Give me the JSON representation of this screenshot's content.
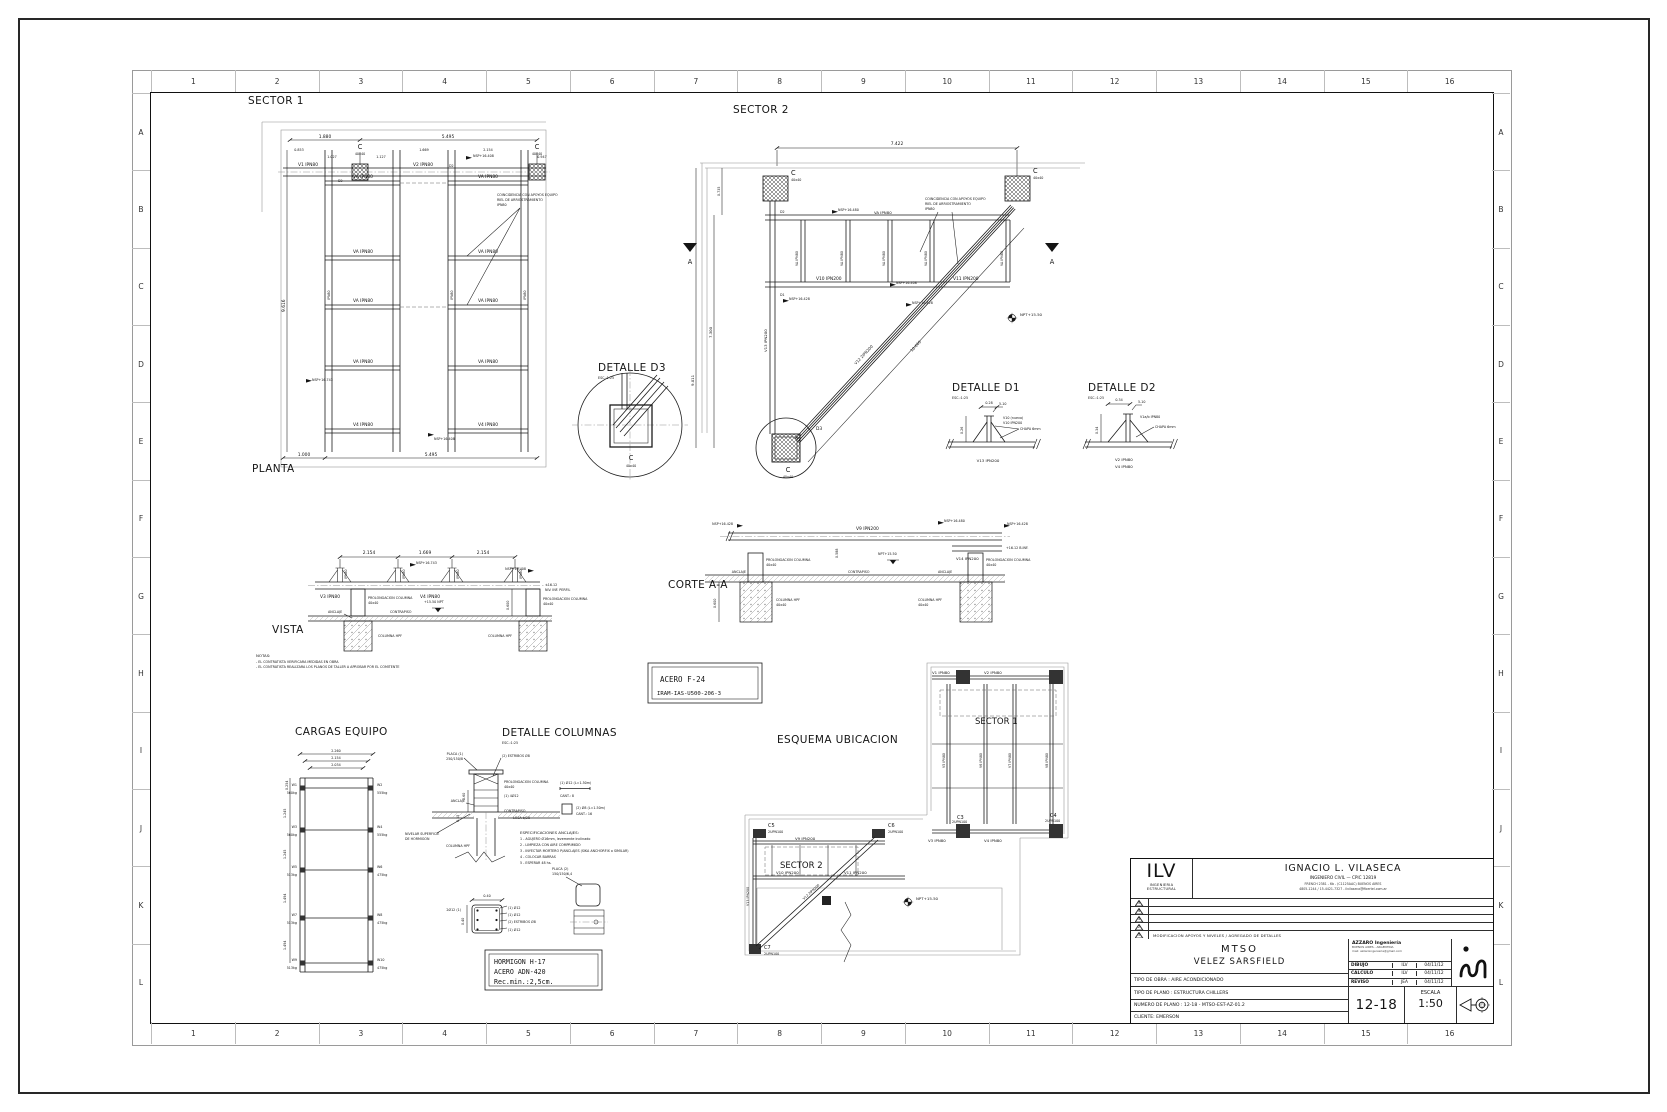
{
  "sheet": {
    "cols": [
      "1",
      "2",
      "3",
      "4",
      "5",
      "6",
      "7",
      "8",
      "9",
      "10",
      "11",
      "12",
      "13",
      "14",
      "15",
      "16"
    ],
    "rows": [
      "A",
      "B",
      "C",
      "D",
      "E",
      "F",
      "G",
      "H",
      "I",
      "J",
      "K",
      "L"
    ]
  },
  "lbl": {
    "va": "VA IPN80",
    "ipn80": "IPN80",
    "c": "C",
    "c40": "40x40",
    "a": "A",
    "nsp408": "NSP+16.408",
    "nsp428": "NSP+16.428",
    "nsp480": "NSP+16.480",
    "nsp743": "NSP+16.743",
    "npt1550": "NPT+15.50",
    "prolong1": "PROLONGACION COLUMNA",
    "prolong2": "40x40",
    "anclaje": "ANCLAJE",
    "contrapiso": "CONTRAPISO",
    "columna_hpf": "COLUMNA HPF",
    "chapa": "CHAPA 6mm",
    "weld": "5-10",
    "esc": "ESC.:1:25",
    "tag_d1": "D1",
    "tag_d2": "D2",
    "tag_d3": "D3"
  },
  "sector1": {
    "title": "SECTOR 1",
    "planta": "PLANTA",
    "dim_top1": "1.880",
    "dim_top2": "5.495",
    "sub": [
      "0.853",
      "1.027",
      "1.127",
      "1.669",
      "2.154",
      "0.947"
    ],
    "dim_left": "9.616",
    "dim_bot1": "1.000",
    "dim_bot2": "5.495",
    "v1": "V1 IPN80",
    "v2": "V2 IPN80",
    "v4": "V4 IPN80",
    "note": [
      "COINCIDENCIA CON APOYOS EQUIPO",
      "RIEL DE ARRIOSTRAMIENTO",
      "IPN80"
    ]
  },
  "sector2": {
    "title": "SECTOR 2",
    "dim_top": "7.422",
    "dim_735": "0.735",
    "dim_7300": "7.300",
    "dim_9011": "9.011",
    "dim_diag": "10.660",
    "v10": "V10 IPN200",
    "v11": "V11 IPN200",
    "v12": "V12 2IPN200",
    "v13": "V13 IPN200"
  },
  "detalles": {
    "d3_title": "DETALLE D3",
    "d1_title": "DETALLE D1",
    "d2_title": "DETALLE D2",
    "d1_dim_h": "0.28",
    "d1_dim_v": "0.26",
    "d1_new": "V10 (nuevo)",
    "d1_perfil": "V10 IPN200",
    "d1_below": "V13 IPN200",
    "d2_dim_h": "0.34",
    "d2_dim_v": "0.34",
    "d2_perfil": "V1a/b IPN80",
    "d2_below1": "V2 IPN80",
    "d2_below2": "V4 IPN80"
  },
  "vista": {
    "title": "VISTA",
    "dims": [
      "2.154",
      "1.669",
      "2.154"
    ],
    "v3": "V3 IPN80",
    "v4": "V4 IPN80",
    "dim_v": "0.600",
    "npt": "+15.50 NPT",
    "inf1": "+16.12",
    "inf2": "NIV. INF. PERFIL"
  },
  "corte": {
    "title": "CORTE A-A",
    "v9": "V9 IPN200",
    "v14": "V14 IPN200",
    "dim1": "0.600",
    "dim2": "0.588",
    "inf": "+16.12 B.INF."
  },
  "notas": {
    "title": "NOTAS:",
    "l1": "- EL CONTRATISTA VERIFICARA MEDIDAS EN OBRA",
    "l2": "- EL CONTRATISTA REALIZARA LOS PLANOS DE TALLER A APROBAR POR EL COMITENTE"
  },
  "acero": {
    "l1": "ACERO  F-24",
    "l2": "IRAM-IAS-U500-206-3"
  },
  "hormigon": {
    "l1": "HORMIGON H-17",
    "l2": "ACERO ADN-420",
    "l3": "Rec.min.:2,5cm."
  },
  "cargas": {
    "title": "CARGAS EQUIPO",
    "dims_top": [
      "2.260",
      "2.154",
      "2.034"
    ],
    "dims_left": [
      "0.254",
      "1.245",
      "1.245",
      "1.494",
      "1.494"
    ],
    "rows": [
      {
        "wl": "W1",
        "kl": "560kg",
        "wr": "W2",
        "kr": "555kg"
      },
      {
        "wl": "W3",
        "kl": "560kg",
        "wr": "W4",
        "kr": "555kg"
      },
      {
        "wl": "W5",
        "kl": "513kg",
        "wr": "W6",
        "kr": "475kg"
      },
      {
        "wl": "W7",
        "kl": "513kg",
        "wr": "W8",
        "kr": "475kg"
      },
      {
        "wl": "W9",
        "kl": "513kg",
        "wr": "W10",
        "kr": "475kg"
      }
    ]
  },
  "columnas": {
    "title": "DETALLE COLUMNAS",
    "placa1a": "PLACA (1)",
    "placa1b": "250/150/8",
    "estribos": "(2) ESTRIBOS Ø8",
    "barras": "(1) 4Ø12",
    "losa": "LOSA e/20",
    "nivelar1": "NIVELAR SUPERFICIE",
    "nivelar2": "DE HORMIGON",
    "col_dim1": "0.60",
    "col_dim2": "0.15",
    "specs": [
      "ESPECIFICACIONES ANCLAJES:",
      "1 - AGUJERO Ø16mm, levemente inclinado",
      "2 - LIMPIEZA CON AIRE COMPRIMIDO",
      "3 - INYECTAR MORTERO P/ANCLAJES (SIKA ANCHORFIX o SIMILAR)",
      "4 - COLOCAR BARRAS",
      "5 - ESPERAR 48 hs."
    ],
    "sec_dim": "0.40",
    "sec_l": "2Ø12 (1)",
    "sec_r1": "(1) Ø12",
    "sec_r2": "(1) Ø12",
    "sec_r3": "(2) ESTRIBOS Ø8",
    "sec_r4": "(1) Ø12",
    "sch1a": "(1) Ø12 (L=1.50m)",
    "sch1b": "CANT.: 8",
    "sch2a": "(2) Ø8 (L=1.50m)",
    "sch2b": "CANT.: 16",
    "placa2a": "PLACA (2)",
    "placa2b": "150/150/6,4"
  },
  "esquema": {
    "title": "ESQUEMA UBICACION",
    "s1": "SECTOR 1",
    "s2": "SECTOR 2",
    "v1": "V1 IPN80",
    "v2": "V2 IPN80",
    "v3": "V3 IPN80",
    "v4": "V4 IPN80",
    "v5": "V5 IPN80",
    "v6": "V6 IPN80",
    "v7": "V7 IPN80",
    "v8": "V8 IPN80",
    "v9": "V9 IPN200",
    "v10": "V10 IPN200",
    "v11": "V11 IPN200",
    "v12": "V12 2IPN200",
    "v13": "V13 IPN200",
    "c3": "C3",
    "c4": "C4",
    "c5": "C5",
    "c6": "C6",
    "c7": "C7",
    "upn": "2UPN100"
  },
  "titleblock": {
    "logo": "ILV",
    "logo_sub1": "INGENIERIA",
    "logo_sub2": "ESTRUCTURAL",
    "name": "IGNACIO L. VILASECA",
    "role": "INGENIERO CIVIL  —  CPIC 12819",
    "addr1": "FRENCH 2381 - 6b - (C1125AAC) BUENOS AIRES",
    "addr2": "4805-1244 / 15-4421-7327 - ilvilaseca@fibertel.com.ar",
    "revisions": [
      {
        "n": "5",
        "text": ""
      },
      {
        "n": "4",
        "text": ""
      },
      {
        "n": "3",
        "text": ""
      },
      {
        "n": "2",
        "text": ""
      },
      {
        "n": "1",
        "text": "MODIFICACION APOYOS Y NIVELES / AGREGADO DE DETALLES"
      }
    ],
    "project1": "MTSO",
    "project2": "VELEZ SARSFIELD",
    "azzaro": "AZZARO Ingeniería",
    "azzaro_sub1": "BUENOS AIRES - ARGENTINA",
    "azzaro_sub2": "mail: azzaroingenieria@gmail.com",
    "table": [
      {
        "label": "DIBUJO",
        "by": "ILV",
        "date": "04/11/12"
      },
      {
        "label": "CALCULO",
        "by": "ILV",
        "date": "04/11/12"
      },
      {
        "label": "REVISO",
        "by": "JEA",
        "date": "04/11/12"
      }
    ],
    "tipo_obra": "TIPO DE OBRA : AIRE ACONDICIONADO",
    "tipo_plano": "TIPO DE PLANO : ESTRUCTURA CHILLERS",
    "numero": "NUMERO DE PLANO : 12-18 - MTSO-EST-AZ-01.2",
    "cliente": "CLIENTE: EMERSON",
    "num_big": "12-18",
    "escala_label": "ESCALA",
    "escala_value": "1:50"
  }
}
